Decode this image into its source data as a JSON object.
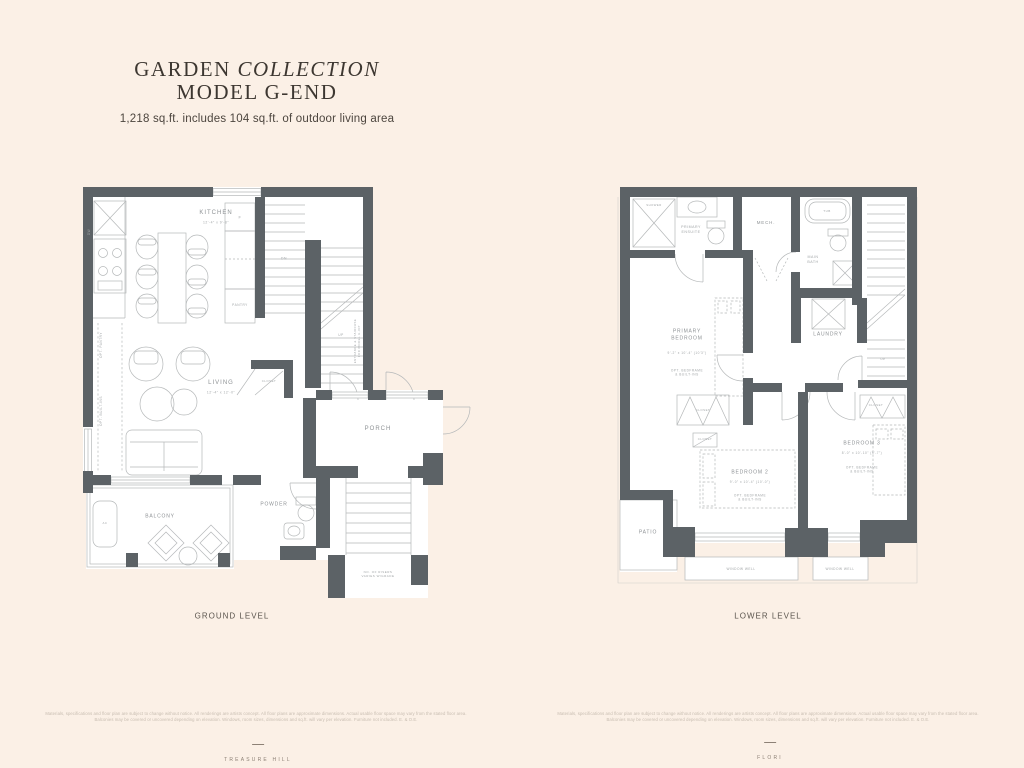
{
  "page": {
    "title_regular": "GARDEN",
    "title_italic": "COLLECTION",
    "title_line2": "MODEL G-END",
    "subtitle": "1,218 sq.ft. includes 104 sq.ft. of outdoor living area",
    "footer": {
      "disclaimer_line1": "Materials, specifications and floor plan are subject to change without notice. All renderings are artists concept. All floor plans are approximate dimensions. Actual usable floor space may vary from the stated floor area.",
      "disclaimer_line2": "Balconies may be covered or uncovered depending on elevation. Windows, room sizes, dimensions and sq.ft. will vary per elevation. Furniture not included. E. & O.E.",
      "brand_left": "TREASURE HILL",
      "brand_right": "FLORI"
    }
  },
  "ground": {
    "caption": "GROUND LEVEL",
    "labels": {
      "kitchen": "KITCHEN",
      "kitchen_dims": "12'-4\" x 9'-8\"",
      "living": "LIVING",
      "living_dims": "12'-4\" x 12'-0\"",
      "porch": "PORCH",
      "balcony": "BALCONY",
      "powder": "POWDER",
      "closet": "CLOSET",
      "pantry": "PANTRY",
      "fridge": "F",
      "dishwasher": "DW",
      "ac": "AC",
      "dn": "DN",
      "up": "UP",
      "opt_pantry": "OPT. PANTRY",
      "opt_builtins": "OPT. BUILT-INS",
      "stair_note": "ENTRANCE & STAIRCASE\nFOR MODEL U-INT",
      "risers_note": "NO. OF RISERS\nVARIES W/GRADE"
    }
  },
  "lower": {
    "caption": "LOWER LEVEL",
    "labels": {
      "shower": "SHOWER",
      "primary_ensuite": "PRIMARY\nENSUITE",
      "mech": "MECH.",
      "tub": "TUB",
      "main_bath": "MAIN\nBATH",
      "laundry": "LAUNDRY",
      "up": "UP",
      "primary_bedroom": "PRIMARY\nBEDROOM",
      "primary_bedroom_dims": "9'-2\" x 10'-4\" (10'3\")",
      "primary_opt": "OPT. BEDFRAME\n& BUILT-INS",
      "closet1": "CLOSET",
      "closet2": "CLOSET",
      "closet3": "CLOSET",
      "bedroom2": "BEDROOM 2",
      "bedroom2_dims": "9'-0\" x 10'-4\" (10'-0\")",
      "bedroom2_opt": "OPT. BEDFRAME\n& BUILT-INS",
      "bedroom3": "BEDROOM 3",
      "bedroom3_dims": "8'-0\" x 10'-10\" (9'-7\")",
      "bedroom3_opt": "OPT. BEDFRAME\n& BUILT-INS",
      "patio": "PATIO",
      "window_well1": "WINDOW WELL",
      "window_well2": "WINDOW WELL"
    }
  }
}
